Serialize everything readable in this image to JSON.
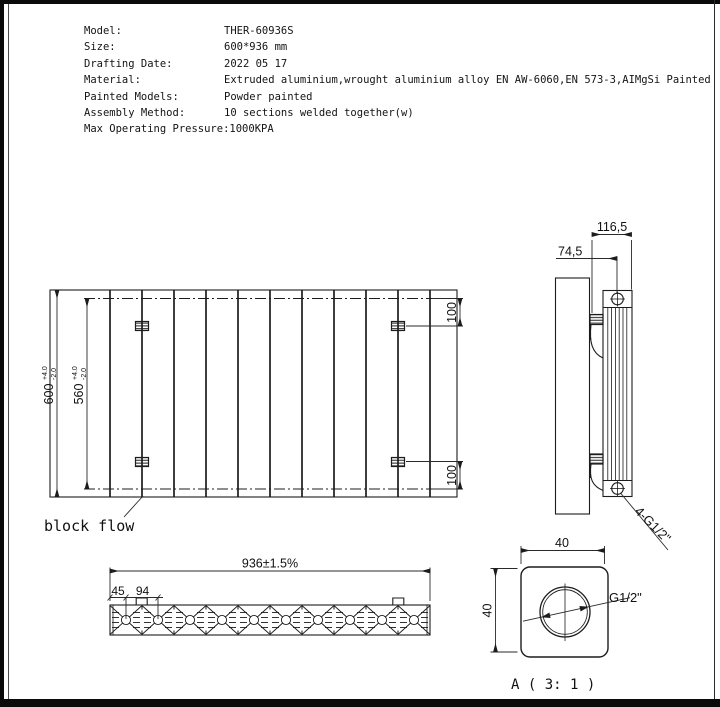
{
  "title_block": {
    "rows": [
      {
        "label": "Model:",
        "value": "THER-60936S"
      },
      {
        "label": "Size:",
        "value": "600*936 mm"
      },
      {
        "label": "Drafting Date:",
        "value": "2022 05 17"
      },
      {
        "label": "Material:",
        "value": "Extruded aluminium,wrought aluminium alloy EN AW-6060,EN 573-3,AIMgSi Painted"
      },
      {
        "label": "Painted Models:",
        "value": "Powder painted"
      },
      {
        "label": "Assembly Method:",
        "value": "10 sections welded together(w)"
      },
      {
        "label": "Max Operating Pressure:",
        "value": "1000KPA"
      }
    ]
  },
  "front_view": {
    "height_dim": {
      "value": "600",
      "tol_plus": "+4.0",
      "tol_minus": "-2.0"
    },
    "inner_dim": {
      "value": "560",
      "tol_plus": "+4.0",
      "tol_minus": "-2.0"
    },
    "top_offset_dim": "100",
    "bottom_offset_dim": "100",
    "block_flow_label": "block flow"
  },
  "side_view": {
    "depth_dim": "116,5",
    "valve_offset_dim": "74,5",
    "connection_label": "4-G1/2\""
  },
  "section_view": {
    "width_dim": "936±1.5%",
    "edge_dim": "45",
    "pitch_dim": "94"
  },
  "detail_view": {
    "width_dim": "40",
    "height_dim": "40",
    "thread_label": "G1/2\"",
    "caption": "A ( 3: 1 )"
  },
  "colors": {
    "line": "#1c1c1c",
    "background": "#ffffff"
  }
}
